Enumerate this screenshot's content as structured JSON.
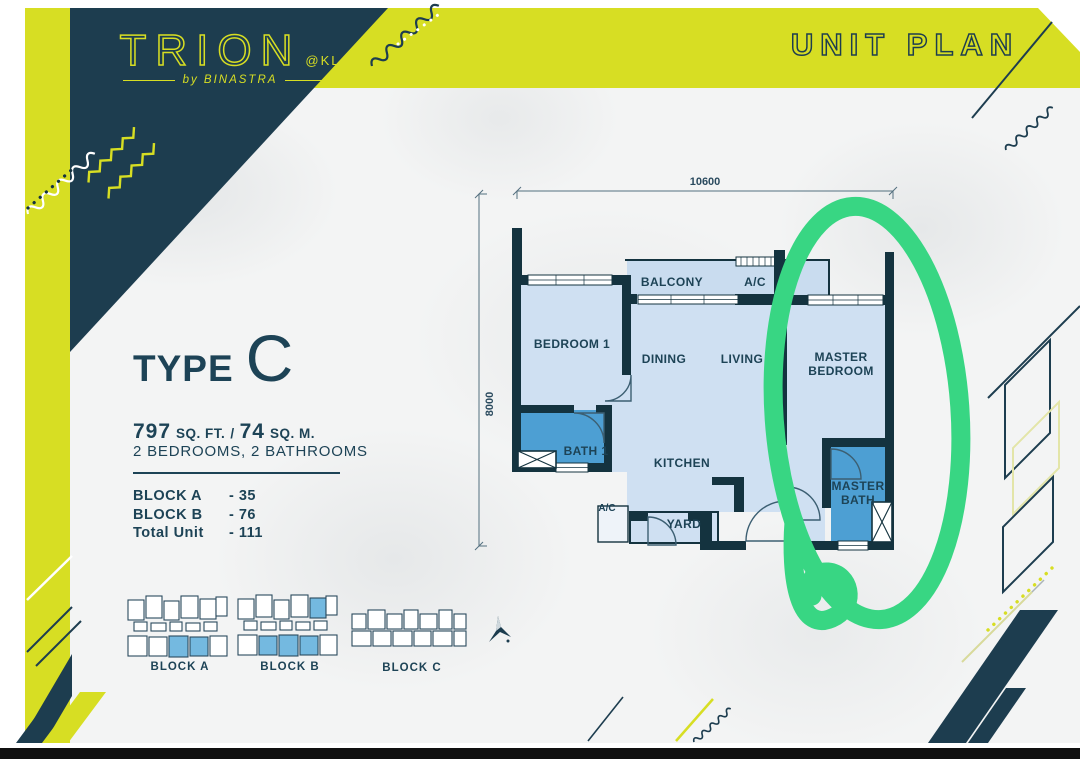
{
  "colors": {
    "lime": "#d7de23",
    "navy": "#1d3d4f",
    "wall": "#14333f",
    "room_light": "#cfe0f2",
    "room_pale": "#c9dcef",
    "bath_blue": "#4d9fd3",
    "key_blue": "#74b9e0",
    "green": "#38d683",
    "text_navy": "#1d4356"
  },
  "brand": {
    "title": "TRION",
    "at": "@KL",
    "byline": "by BINASTRA"
  },
  "header": {
    "title": "UNIT PLAN"
  },
  "unit": {
    "type_word": "TYPE",
    "type_letter": "C",
    "area_sqft": "797",
    "area_sqft_unit": "SQ. FT.",
    "area_sep": "/",
    "area_sqm": "74",
    "area_sqm_unit": "SQ. M.",
    "bedbath": "2 BEDROOMS, 2 BATHROOMS",
    "stats": [
      {
        "label": "BLOCK A",
        "value": "- 35"
      },
      {
        "label": "BLOCK B",
        "value": "- 76"
      },
      {
        "label": "Total Unit",
        "value": "- 111"
      }
    ]
  },
  "floorplan": {
    "dim_top": "10600",
    "dim_left": "8000",
    "labels": {
      "bedroom1": "BEDROOM 1",
      "balcony": "BALCONY",
      "ac_top": "A/C",
      "dining": "DINING",
      "living": "LIVING",
      "master1": "MASTER",
      "master2": "BEDROOM",
      "bath1": "BATH 1",
      "kitchen": "KITCHEN",
      "ac_bottom": "A/C",
      "yard": "YARD",
      "mbath1": "MASTER",
      "mbath2": "BATH"
    }
  },
  "keyplans": {
    "a": "BLOCK A",
    "b": "BLOCK B",
    "c": "BLOCK C"
  }
}
